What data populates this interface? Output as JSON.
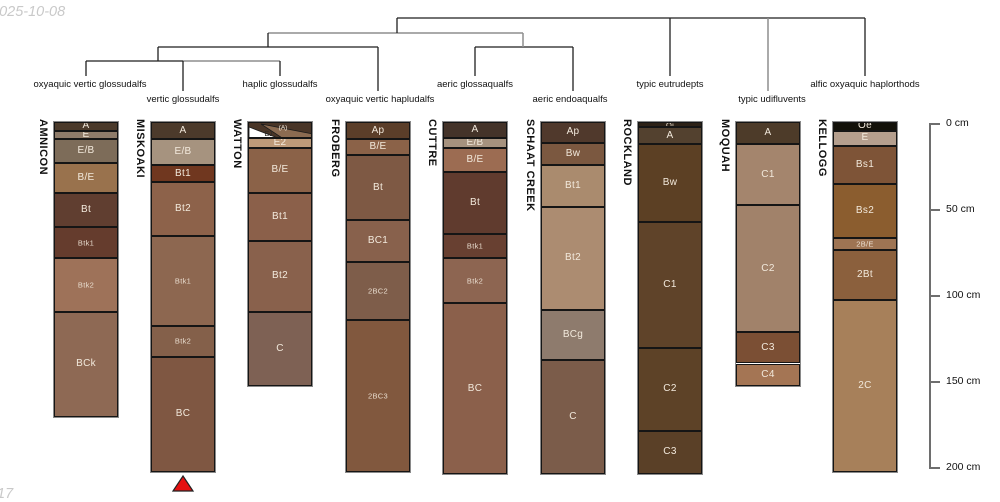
{
  "watermark_top": "2025-10-08",
  "watermark_bottom": "17",
  "chart_data": {
    "type": "bar",
    "variant": "soil-profile-horizon-columns-with-taxonomy-dendrogram",
    "title": "",
    "depth_axis": {
      "unit": "cm",
      "side": "right",
      "range_cm": [
        0,
        200
      ],
      "ticks": [
        {
          "cm": 0,
          "label": "0 cm"
        },
        {
          "cm": 50,
          "label": "50 cm"
        },
        {
          "cm": 100,
          "label": "100 cm"
        },
        {
          "cm": 150,
          "label": "150 cm"
        },
        {
          "cm": 200,
          "label": "200 cm"
        }
      ]
    },
    "profiles": [
      {
        "name": "AMNICON",
        "taxon": "oxyaquic vertic glossudalfs",
        "horizons": [
          {
            "label": "A",
            "top_cm": 0,
            "bottom_cm": 5,
            "color": "#4b3a2b"
          },
          {
            "label": "E",
            "top_cm": 5,
            "bottom_cm": 10,
            "color": "#8e7b69"
          },
          {
            "label": "E/B",
            "top_cm": 10,
            "bottom_cm": 24,
            "color": "#7d6c59"
          },
          {
            "label": "B/E",
            "top_cm": 24,
            "bottom_cm": 41,
            "color": "#99724d"
          },
          {
            "label": "Bt",
            "top_cm": 41,
            "bottom_cm": 61,
            "color": "#603e30"
          },
          {
            "label": "Btk1",
            "top_cm": 61,
            "bottom_cm": 79,
            "color": "#653c2d",
            "small": true
          },
          {
            "label": "Btk2",
            "top_cm": 79,
            "bottom_cm": 110,
            "color": "#9e7259",
            "small": true
          },
          {
            "label": "BCk",
            "top_cm": 110,
            "bottom_cm": 171,
            "color": "#8e6954"
          }
        ]
      },
      {
        "name": "MISKOAKI",
        "taxon": "vertic glossudalfs",
        "horizons": [
          {
            "label": "A",
            "top_cm": 0,
            "bottom_cm": 10,
            "color": "#4c3a2b"
          },
          {
            "label": "E/B",
            "top_cm": 10,
            "bottom_cm": 25,
            "color": "#a6937f"
          },
          {
            "label": "Bt1",
            "top_cm": 25,
            "bottom_cm": 35,
            "color": "#70371f"
          },
          {
            "label": "Bt2",
            "top_cm": 35,
            "bottom_cm": 66,
            "color": "#8d624a"
          },
          {
            "label": "Btk1",
            "top_cm": 66,
            "bottom_cm": 118,
            "color": "#8d6750",
            "small": true
          },
          {
            "label": "Btk2",
            "top_cm": 118,
            "bottom_cm": 136,
            "color": "#84604a",
            "small": true
          },
          {
            "label": "BC",
            "top_cm": 136,
            "bottom_cm": 203,
            "color": "#7f5742"
          }
        ]
      },
      {
        "name": "WATTON",
        "taxon": "haplic glossudalfs",
        "horizons": [
          {
            "label": "(A)",
            "label2": "E1",
            "wedge": true,
            "top_cm": 0,
            "bottom_cm": 9,
            "color": "#493527",
            "wedge_white": "#ffffff",
            "wedge_tan": "#8b6b51"
          },
          {
            "label": "E2",
            "top_cm": 9,
            "bottom_cm": 15,
            "color": "#bd9a79"
          },
          {
            "label": "B/E",
            "top_cm": 15,
            "bottom_cm": 41,
            "color": "#8b6248"
          },
          {
            "label": "Bt1",
            "top_cm": 41,
            "bottom_cm": 69,
            "color": "#8b604a"
          },
          {
            "label": "Bt2",
            "top_cm": 69,
            "bottom_cm": 110,
            "color": "#89614c"
          },
          {
            "label": "C",
            "top_cm": 110,
            "bottom_cm": 153,
            "color": "#7e6154"
          }
        ]
      },
      {
        "name": "FROBERG",
        "taxon": "oxyaquic vertic hapludalfs",
        "horizons": [
          {
            "label": "Ap",
            "top_cm": 0,
            "bottom_cm": 10,
            "color": "#5b3e29"
          },
          {
            "label": "B/E",
            "top_cm": 10,
            "bottom_cm": 19,
            "color": "#8b6248"
          },
          {
            "label": "Bt",
            "top_cm": 19,
            "bottom_cm": 57,
            "color": "#7e5944"
          },
          {
            "label": "BC1",
            "top_cm": 57,
            "bottom_cm": 81,
            "color": "#88614c"
          },
          {
            "label": "2BC2",
            "top_cm": 81,
            "bottom_cm": 115,
            "color": "#7e5d4a",
            "small": true
          },
          {
            "label": "2BC3",
            "top_cm": 115,
            "bottom_cm": 203,
            "color": "#81583e",
            "small": true
          }
        ]
      },
      {
        "name": "CUTTRE",
        "taxon": "aeric glossaqualfs",
        "horizons": [
          {
            "label": "A",
            "top_cm": 0,
            "bottom_cm": 9,
            "color": "#443329"
          },
          {
            "label": "E/B",
            "top_cm": 9,
            "bottom_cm": 15,
            "color": "#a6927e"
          },
          {
            "label": "B/E",
            "top_cm": 15,
            "bottom_cm": 29,
            "color": "#9c6c52"
          },
          {
            "label": "Bt",
            "top_cm": 29,
            "bottom_cm": 65,
            "color": "#603b2e"
          },
          {
            "label": "Btk1",
            "top_cm": 65,
            "bottom_cm": 79,
            "color": "#684031",
            "small": true
          },
          {
            "label": "Btk2",
            "top_cm": 79,
            "bottom_cm": 105,
            "color": "#8d6551",
            "small": true
          },
          {
            "label": "BC",
            "top_cm": 105,
            "bottom_cm": 204,
            "color": "#8b604b"
          }
        ]
      },
      {
        "name": "SCHAAT CREEK",
        "taxon": "aeric endoaqualfs",
        "horizons": [
          {
            "label": "Ap",
            "top_cm": 0,
            "bottom_cm": 12,
            "color": "#50392c"
          },
          {
            "label": "Bw",
            "top_cm": 12,
            "bottom_cm": 25,
            "color": "#7b5840"
          },
          {
            "label": "Bt1",
            "top_cm": 25,
            "bottom_cm": 49,
            "color": "#aa8b6e"
          },
          {
            "label": "Bt2",
            "top_cm": 49,
            "bottom_cm": 109,
            "color": "#ac8c71"
          },
          {
            "label": "BCg",
            "top_cm": 109,
            "bottom_cm": 138,
            "color": "#8e7b6d"
          },
          {
            "label": "C",
            "top_cm": 138,
            "bottom_cm": 204,
            "color": "#7b5c4a"
          }
        ]
      },
      {
        "name": "ROCKLAND",
        "taxon": "typic eutrudepts",
        "horizons": [
          {
            "label": "Oi",
            "top_cm": 0,
            "bottom_cm": 3,
            "color": "#2d2217",
            "small": true
          },
          {
            "label": "A",
            "top_cm": 3,
            "bottom_cm": 13,
            "color": "#53412f"
          },
          {
            "label": "Bw",
            "top_cm": 13,
            "bottom_cm": 58,
            "color": "#5c4024"
          },
          {
            "label": "C1",
            "top_cm": 58,
            "bottom_cm": 131,
            "color": "#5f4329"
          },
          {
            "label": "C2",
            "top_cm": 131,
            "bottom_cm": 179,
            "color": "#5d4227"
          },
          {
            "label": "C3",
            "top_cm": 179,
            "bottom_cm": 204,
            "color": "#5a4027"
          }
        ]
      },
      {
        "name": "MOQUAH",
        "taxon": "typic udifluvents",
        "horizons": [
          {
            "label": "A",
            "top_cm": 0,
            "bottom_cm": 13,
            "color": "#4d3b29"
          },
          {
            "label": "C1",
            "top_cm": 13,
            "bottom_cm": 48,
            "color": "#a4856d"
          },
          {
            "label": "C2",
            "top_cm": 48,
            "bottom_cm": 122,
            "color": "#a1826a"
          },
          {
            "label": "C3",
            "top_cm": 122,
            "bottom_cm": 140,
            "color": "#7b4f34"
          },
          {
            "label": "C4",
            "top_cm": 140,
            "bottom_cm": 153,
            "color": "#a47554"
          }
        ]
      },
      {
        "name": "KELLOGG",
        "taxon": "alfic oxyaquic haplorthods",
        "horizons": [
          {
            "label": "Oe",
            "top_cm": 0,
            "bottom_cm": 5,
            "color": "#121008"
          },
          {
            "label": "E",
            "top_cm": 5,
            "bottom_cm": 14,
            "color": "#b59f8e"
          },
          {
            "label": "Bs1",
            "top_cm": 14,
            "bottom_cm": 36,
            "color": "#7e5437"
          },
          {
            "label": "Bs2",
            "top_cm": 36,
            "bottom_cm": 67,
            "color": "#8b5d2f"
          },
          {
            "label": "2B/E",
            "top_cm": 67,
            "bottom_cm": 74,
            "color": "#9e7453",
            "small": true
          },
          {
            "label": "2Bt",
            "top_cm": 74,
            "bottom_cm": 103,
            "color": "#8b603d"
          },
          {
            "label": "2C",
            "top_cm": 103,
            "bottom_cm": 203,
            "color": "#a7805a"
          }
        ]
      }
    ],
    "dendrogram": {
      "line_color": "#1f1f1f",
      "alt_line_color": "#8e8e8e",
      "segments": [
        {
          "x1": 86,
          "y1": 61,
          "x2": 183,
          "y2": 61,
          "c": "b"
        },
        {
          "x1": 183,
          "y1": 61,
          "x2": 280,
          "y2": 61,
          "c": "g"
        },
        {
          "x1": 86,
          "y1": 61,
          "x2": 86,
          "y2": 76,
          "c": "b"
        },
        {
          "x1": 183,
          "y1": 61,
          "x2": 183,
          "y2": 91,
          "c": "b"
        },
        {
          "x1": 280,
          "y1": 61,
          "x2": 280,
          "y2": 76,
          "c": "b"
        },
        {
          "x1": 158,
          "y1": 47,
          "x2": 158,
          "y2": 61,
          "c": "b"
        },
        {
          "x1": 158,
          "y1": 47,
          "x2": 378,
          "y2": 47,
          "c": "b"
        },
        {
          "x1": 378,
          "y1": 47,
          "x2": 378,
          "y2": 91,
          "c": "b"
        },
        {
          "x1": 475,
          "y1": 47,
          "x2": 573,
          "y2": 47,
          "c": "b"
        },
        {
          "x1": 475,
          "y1": 47,
          "x2": 475,
          "y2": 76,
          "c": "b"
        },
        {
          "x1": 573,
          "y1": 47,
          "x2": 573,
          "y2": 91,
          "c": "b"
        },
        {
          "x1": 523,
          "y1": 33,
          "x2": 523,
          "y2": 47,
          "c": "g"
        },
        {
          "x1": 268,
          "y1": 33,
          "x2": 523,
          "y2": 33,
          "c": "g"
        },
        {
          "x1": 268,
          "y1": 33,
          "x2": 268,
          "y2": 47,
          "c": "b"
        },
        {
          "x1": 397,
          "y1": 18,
          "x2": 865,
          "y2": 18,
          "c": "b"
        },
        {
          "x1": 397,
          "y1": 18,
          "x2": 397,
          "y2": 33,
          "c": "b"
        },
        {
          "x1": 670,
          "y1": 18,
          "x2": 670,
          "y2": 76,
          "c": "b"
        },
        {
          "x1": 768,
          "y1": 18,
          "x2": 768,
          "y2": 91,
          "c": "g"
        },
        {
          "x1": 865,
          "y1": 18,
          "x2": 865,
          "y2": 76,
          "c": "b"
        }
      ],
      "labels": [
        {
          "text": "oxyaquic vertic glossudalfs",
          "x": 90,
          "row": "a"
        },
        {
          "text": "vertic glossudalfs",
          "x": 183,
          "row": "b"
        },
        {
          "text": "haplic glossudalfs",
          "x": 280,
          "row": "a"
        },
        {
          "text": "oxyaquic vertic hapludalfs",
          "x": 380,
          "row": "b"
        },
        {
          "text": "aeric glossaqualfs",
          "x": 475,
          "row": "a"
        },
        {
          "text": "aeric endoaqualfs",
          "x": 570,
          "row": "b"
        },
        {
          "text": "typic eutrudepts",
          "x": 670,
          "row": "a"
        },
        {
          "text": "typic udifluvents",
          "x": 772,
          "row": "b"
        },
        {
          "text": "alfic oxyaquic haplorthods",
          "x": 865,
          "row": "a"
        }
      ]
    },
    "marker": {
      "shape": "red-triangle",
      "under_profile": "MISKOAKI",
      "color": "#e51010"
    }
  }
}
